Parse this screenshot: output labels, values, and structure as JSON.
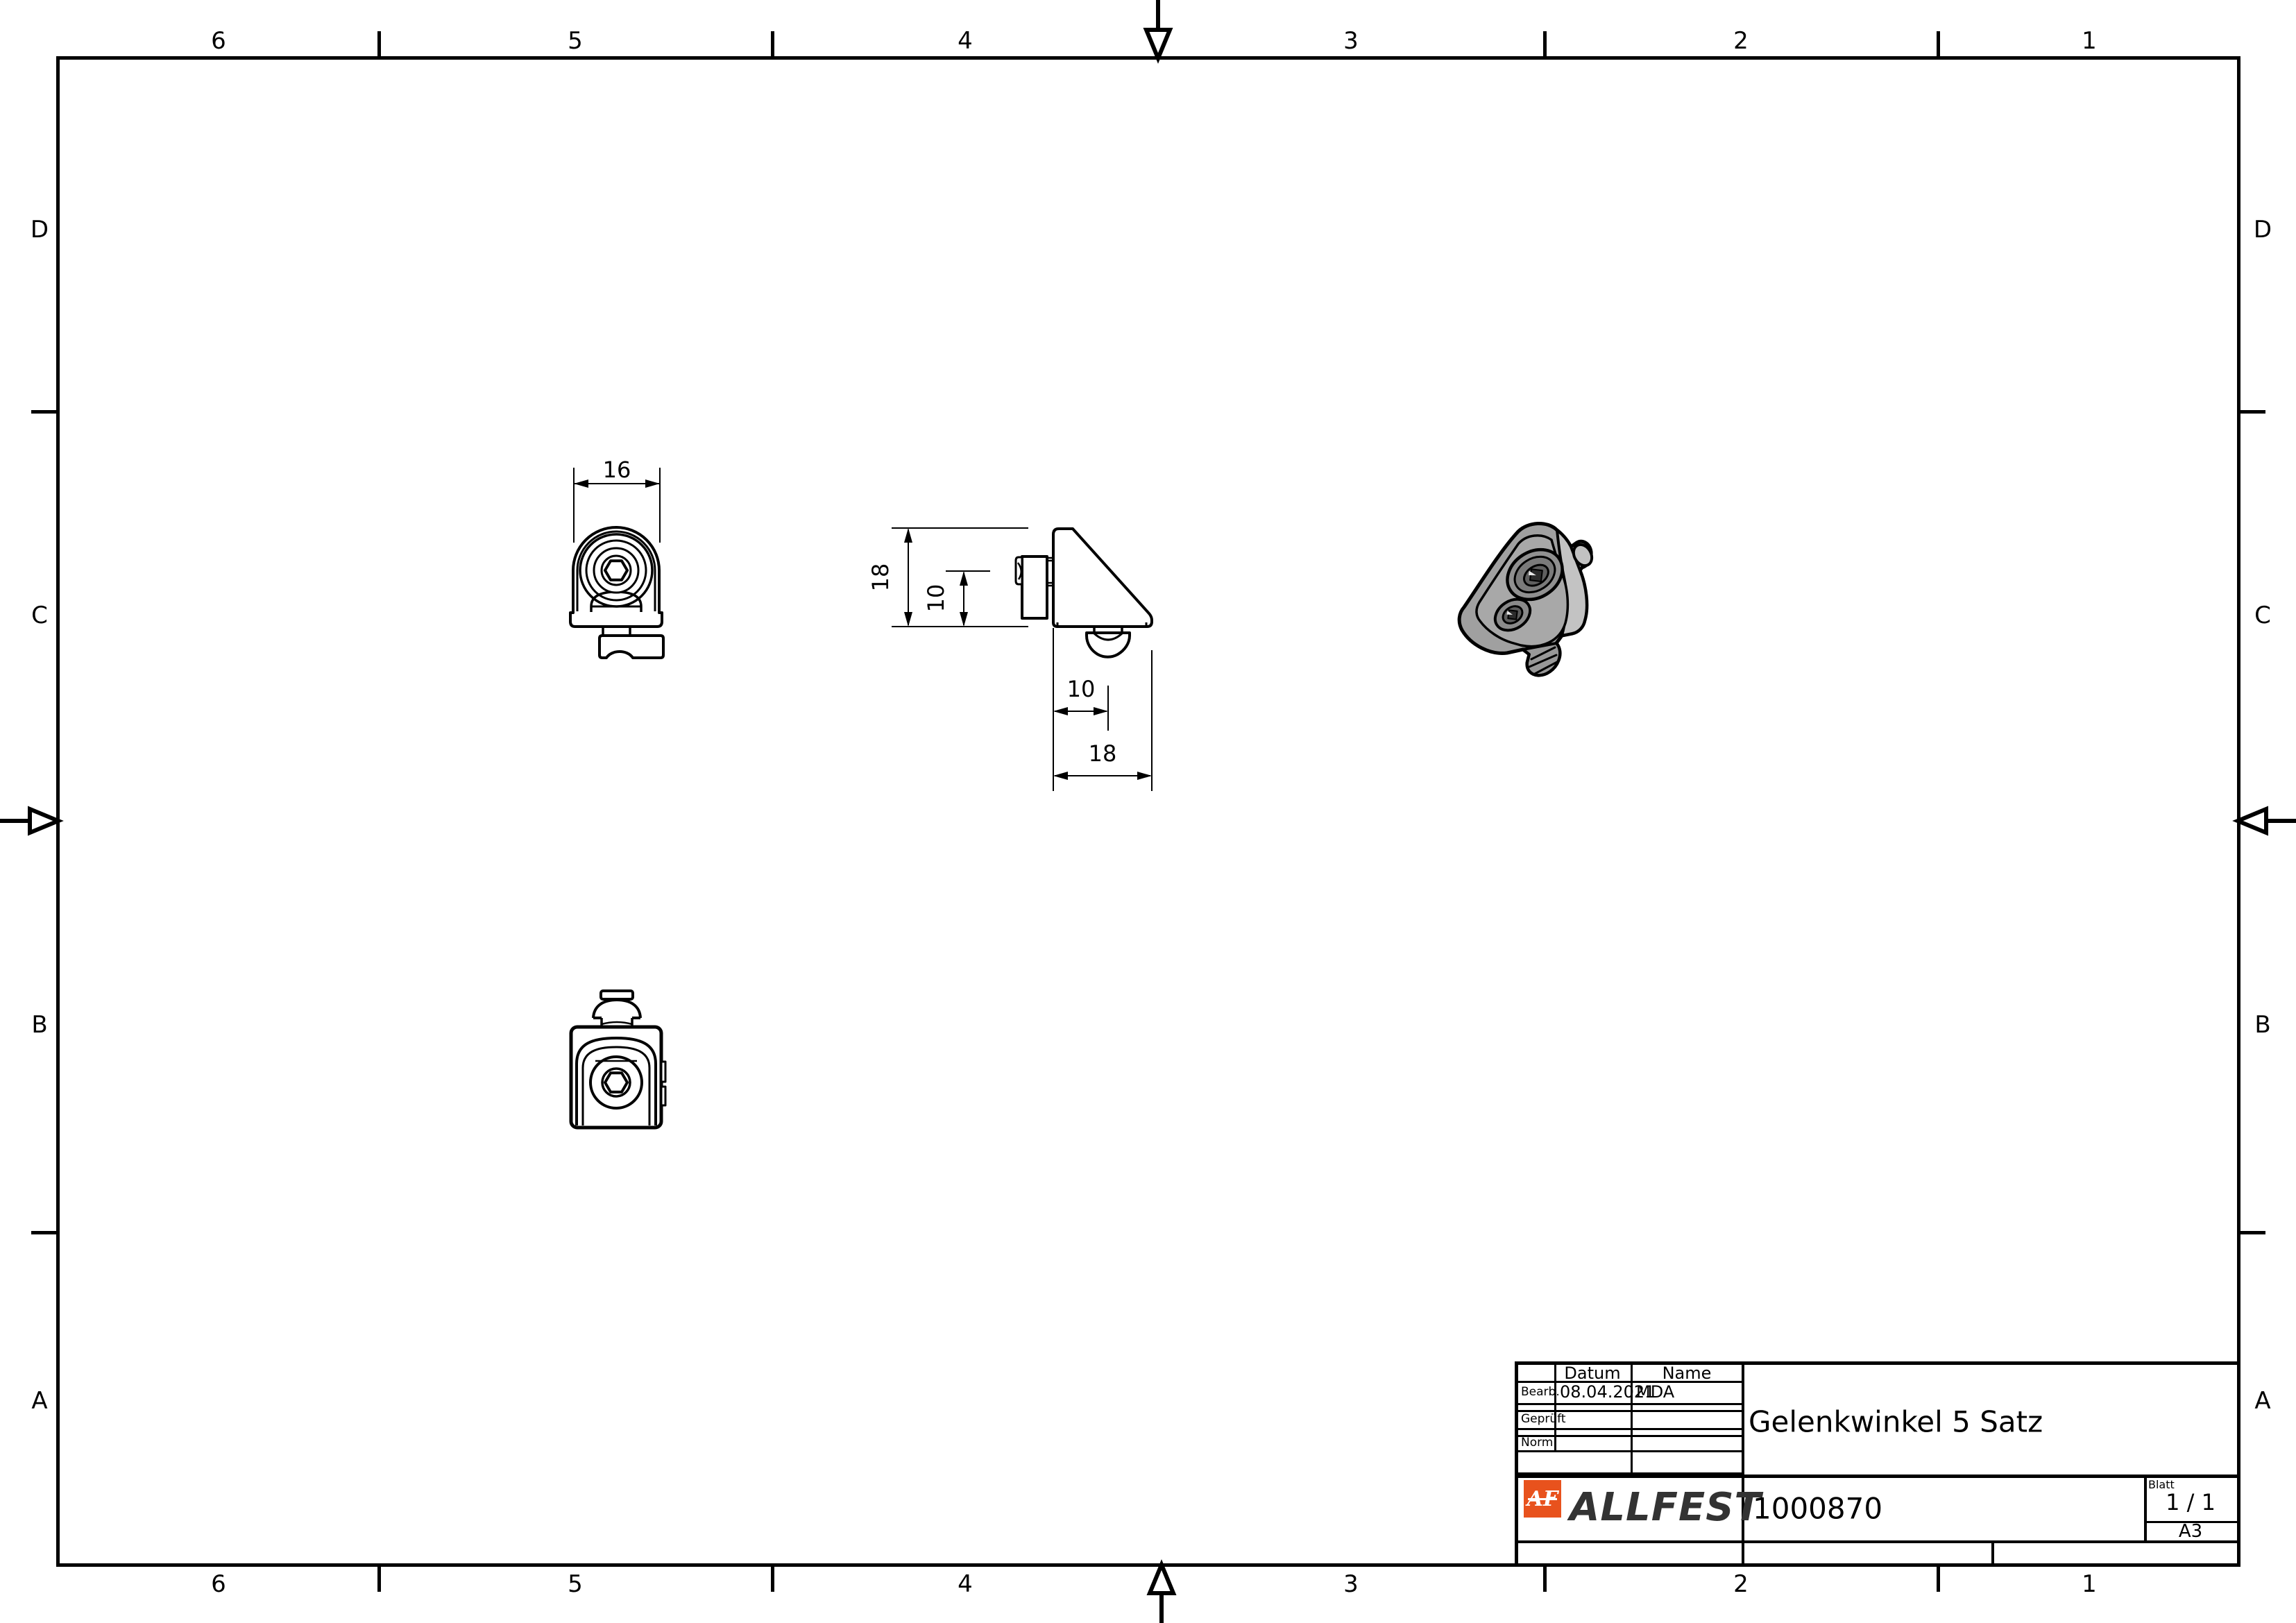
{
  "border": {
    "columns": [
      "6",
      "5",
      "4",
      "3",
      "2",
      "1"
    ],
    "rows": [
      "D",
      "C",
      "B",
      "A"
    ]
  },
  "dimensions": {
    "front_width": "16",
    "side_height": "18",
    "side_height_inner": "10",
    "side_width_inner": "10",
    "side_width": "18"
  },
  "title_block": {
    "table": {
      "col_date": "Datum",
      "col_name": "Name",
      "rows": [
        {
          "label": "Bearb.",
          "date": "08.04.2021",
          "name": "MDA"
        },
        {
          "label": "Geprüft",
          "date": "",
          "name": ""
        },
        {
          "label": "Norm",
          "date": "",
          "name": ""
        }
      ]
    },
    "title": "Gelenkwinkel 5 Satz",
    "part_number": "1000870",
    "sheet_label": "Blatt",
    "sheet_value": "1 / 1",
    "format": "A3",
    "logo": {
      "monogram": "AF",
      "wordmark": "ALLFEST",
      "color": "#E8521D",
      "text_color": "#333333"
    }
  }
}
